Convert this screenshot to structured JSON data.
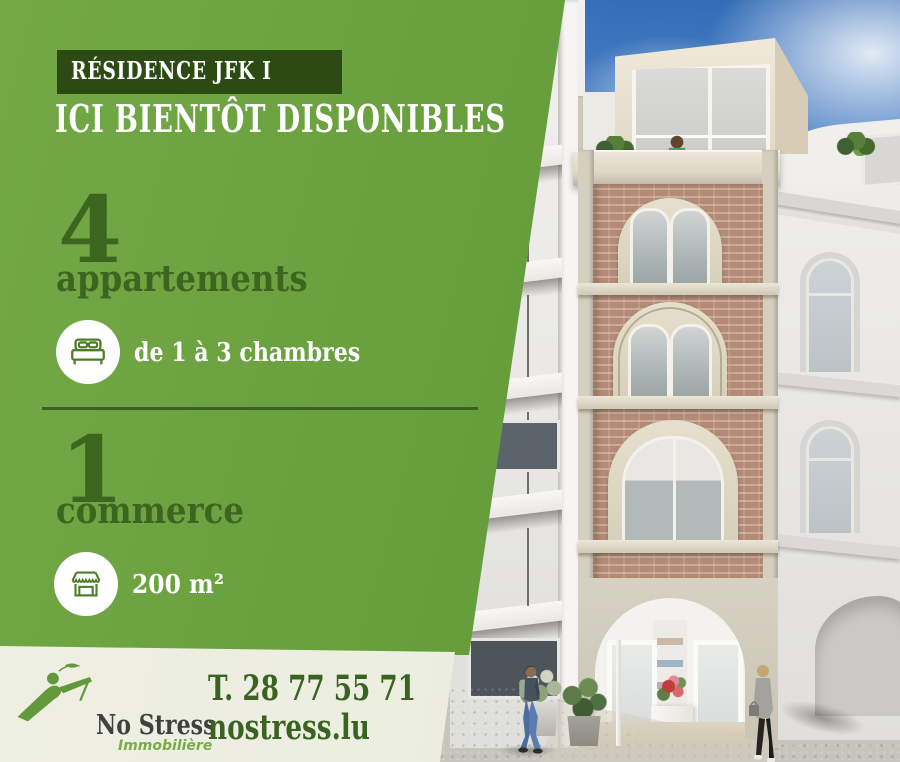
{
  "panel": {
    "badge": "RÉSIDENCE JFK I",
    "headline": "ICI BIENTÔT DISPONIBLES",
    "apartments": {
      "count": "4",
      "label": "appartements",
      "detail": "de 1 à 3 chambres"
    },
    "commerce": {
      "count": "1",
      "label": "commerce",
      "detail": "200 m²"
    }
  },
  "footer": {
    "brand": "No Stress",
    "brand_subtitle": "Immobilière",
    "phone": "T. 28 77 55 71",
    "website": "nostress.lu"
  },
  "icons": {
    "bed": "bed-icon",
    "shop": "storefront-icon",
    "logo": "no-stress-reclining-figure-logo"
  },
  "colors": {
    "green": "#68a03d",
    "dark_green": "#3c661f",
    "badge_green": "#2c4a14",
    "beige_strip": "#ecede0",
    "brick": "#b28a76",
    "sky_top": "#2f6ab5",
    "contact_green": "#3a6322"
  }
}
